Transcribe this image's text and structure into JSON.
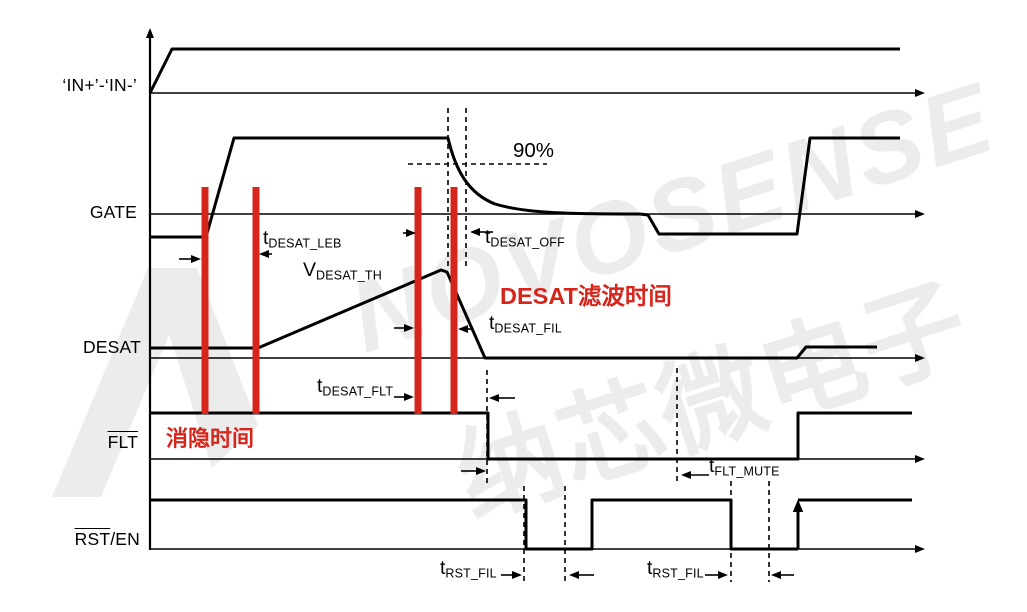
{
  "colors": {
    "ink": "#000000",
    "red": "#d6251b",
    "wm": "#ececec",
    "paper": "#ffffff"
  },
  "signals": {
    "in_label": "‘IN+’-‘IN-’",
    "gate_label": "GATE",
    "desat_label": "DESAT",
    "flt_label": "FLT",
    "rst_label": "RST",
    "rst_suffix": "/EN"
  },
  "annotations": {
    "ninety_percent": "90%",
    "blanking_time_cn": "消隐时间",
    "desat_filter_time_cn": "DESAT滤波时间"
  },
  "timing_labels": {
    "t_desat_leb": {
      "main": "t",
      "sub": "DESAT_LEB"
    },
    "v_desat_th": {
      "main": "V",
      "sub": "DESAT_TH"
    },
    "t_desat_off": {
      "main": "t",
      "sub": "DESAT_OFF"
    },
    "t_desat_fil": {
      "main": "t",
      "sub": "DESAT_FIL"
    },
    "t_desat_flt": {
      "main": "t",
      "sub": "DESAT_FLT"
    },
    "t_flt_mute": {
      "main": "t",
      "sub": "FLT_MUTE"
    },
    "t_rst_fil_1": {
      "main": "t",
      "sub": "RST_FIL"
    },
    "t_rst_fil_2": {
      "main": "t",
      "sub": "RST_FIL"
    }
  },
  "watermark": {
    "line1": "NOVOSENSE",
    "line2": "纳芯微电子"
  }
}
